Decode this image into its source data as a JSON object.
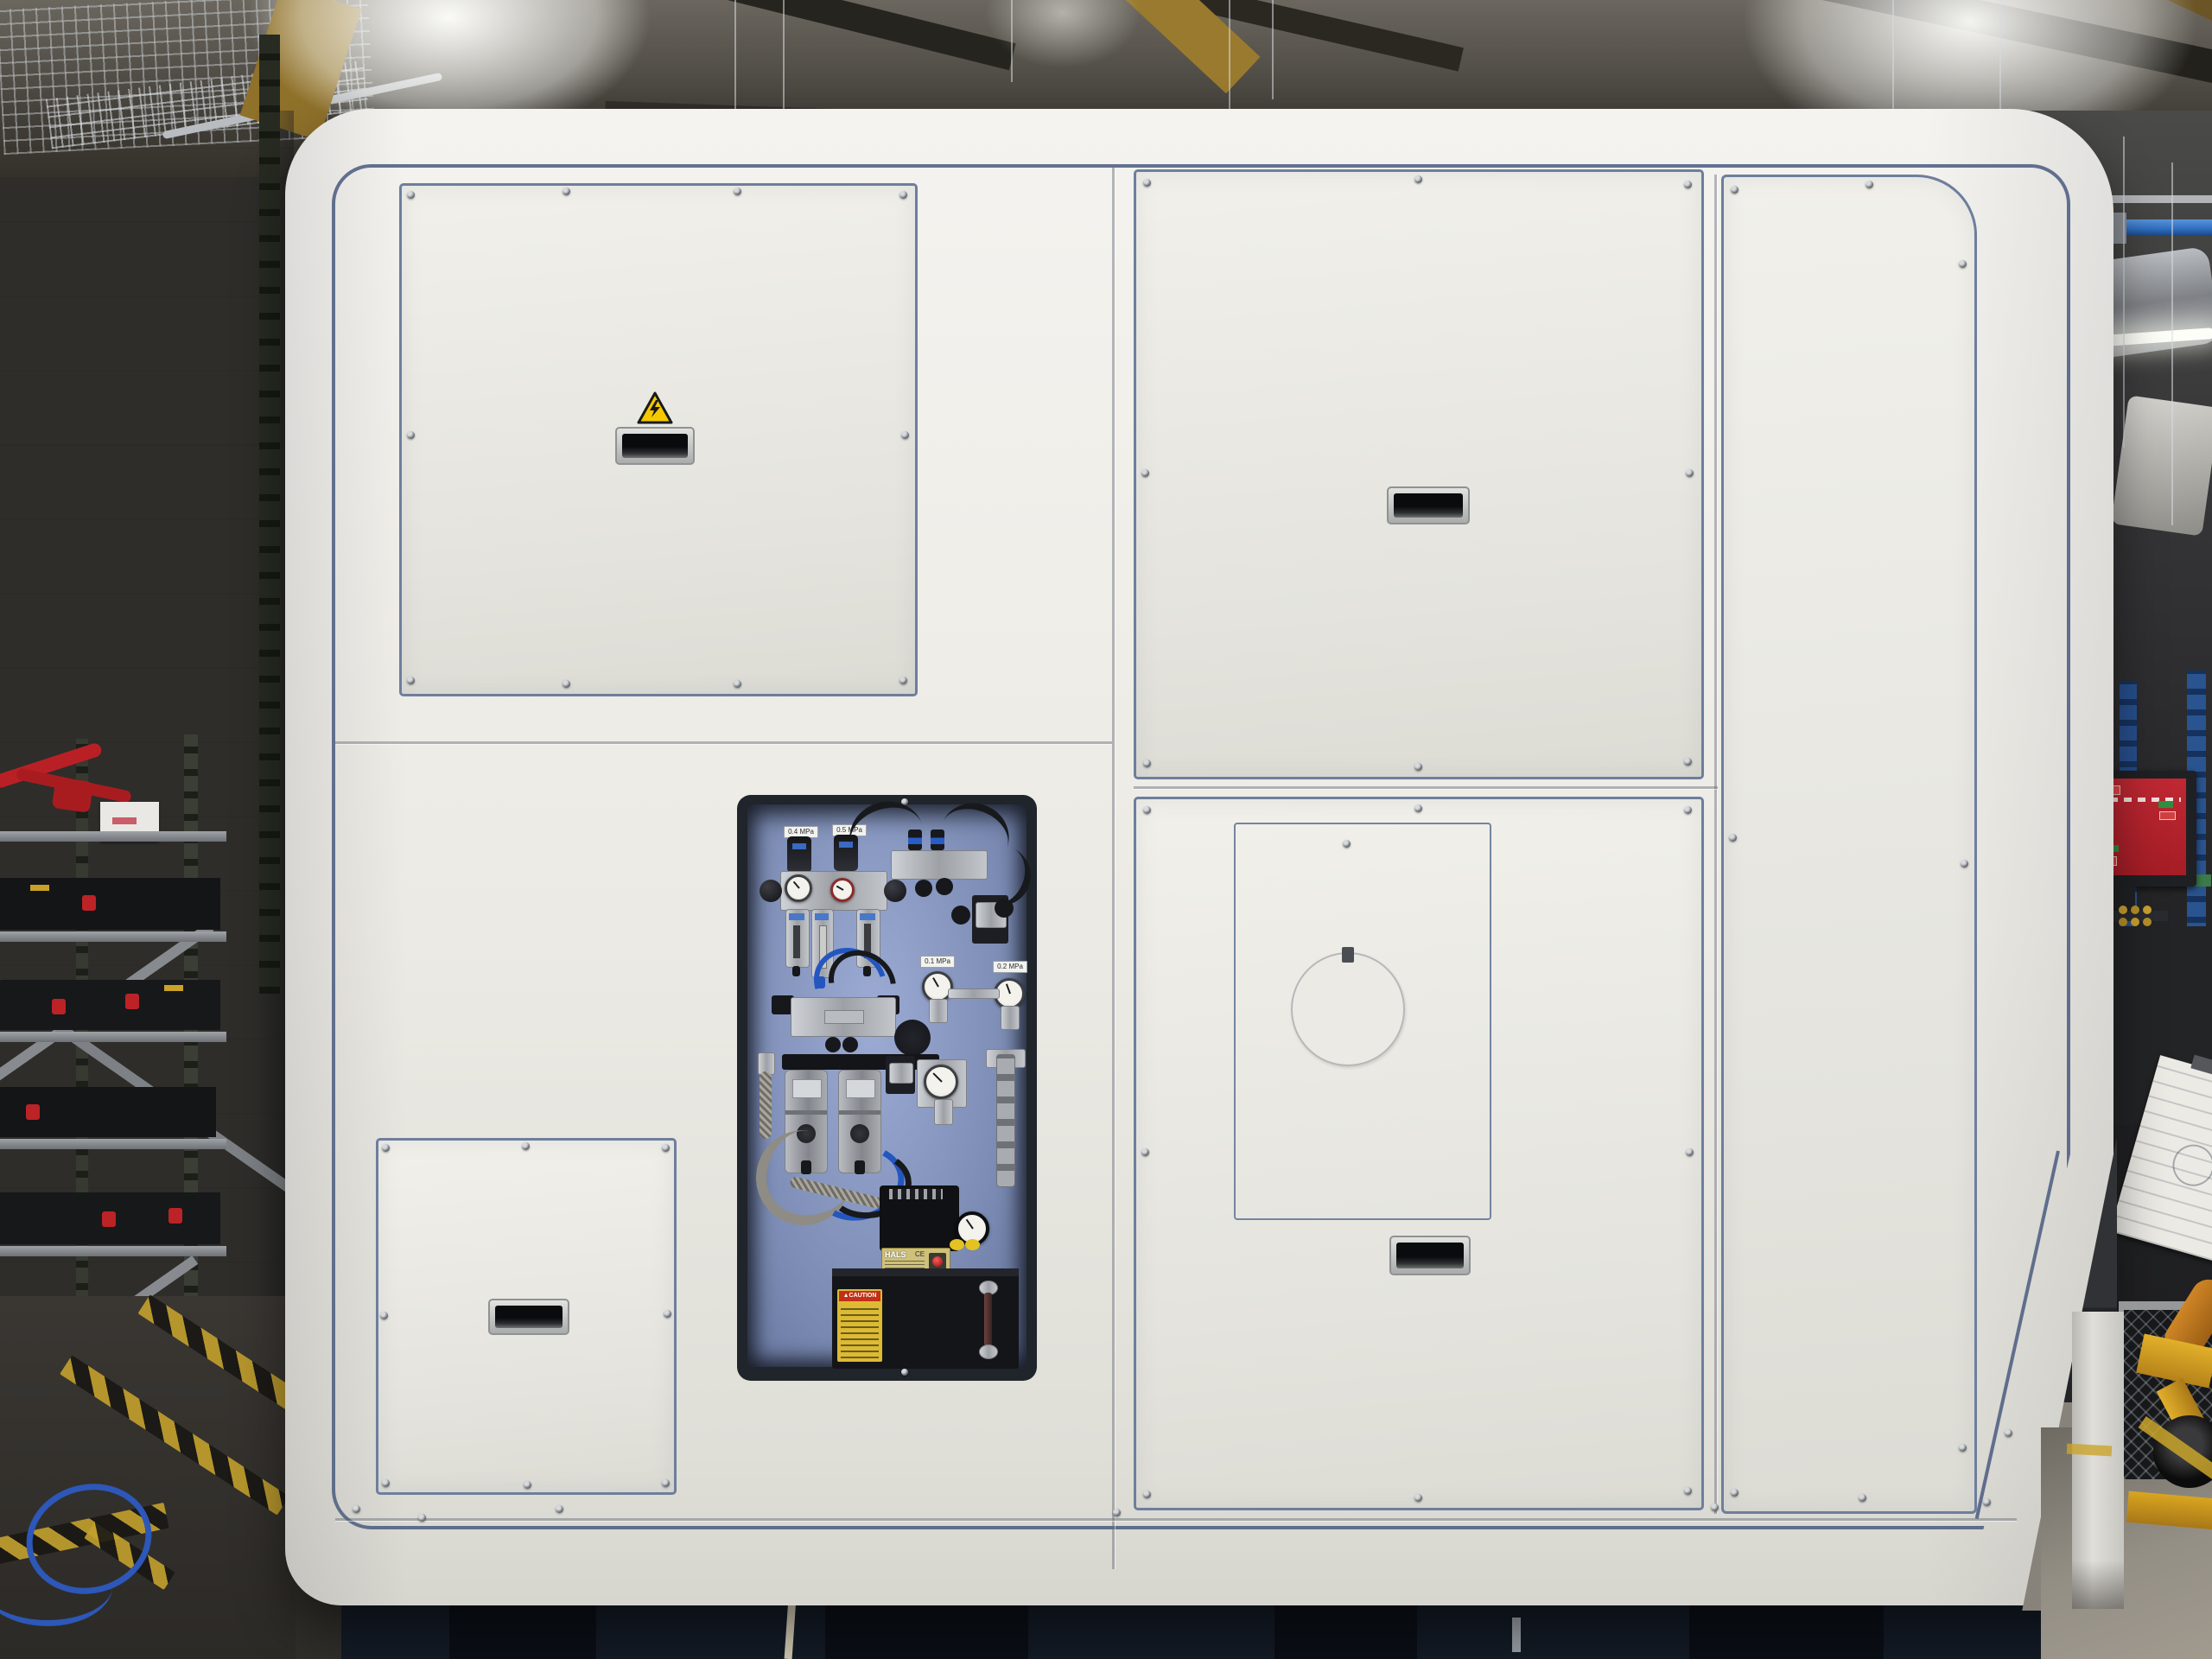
{
  "scene_type": "factory-photo-machine-rear-enclosure",
  "machine": {
    "body_color": "#edece6",
    "pinstripe_color": "#4d5f82",
    "panel_trim_color": "#6e7e9c",
    "warning_sticker": {
      "icon": "electrical-hazard-icon",
      "bg": "#f6c800",
      "glyph": "⚡"
    },
    "handles": {
      "style": "recessed-pull",
      "count": 4
    },
    "pneumatic_bay": {
      "backplate_color": "#8fa0cc",
      "labels": {
        "frl1": "0.4 MPa",
        "frl2": "0.5 MPa",
        "reg1": "0.1 MPa",
        "reg2": "0.2 MPa"
      },
      "pump": {
        "brand": "HALS",
        "ce": "CE"
      },
      "caution_sticker": {
        "title": "CAUTION",
        "bg": "#ddba34"
      }
    }
  },
  "environment": {
    "monitor_screen_color": "#b2222c",
    "hazard_tape_color": "#c3a02c",
    "overhead_pipe_color": "#2f6fc0",
    "cart_color": "#d9a520"
  }
}
